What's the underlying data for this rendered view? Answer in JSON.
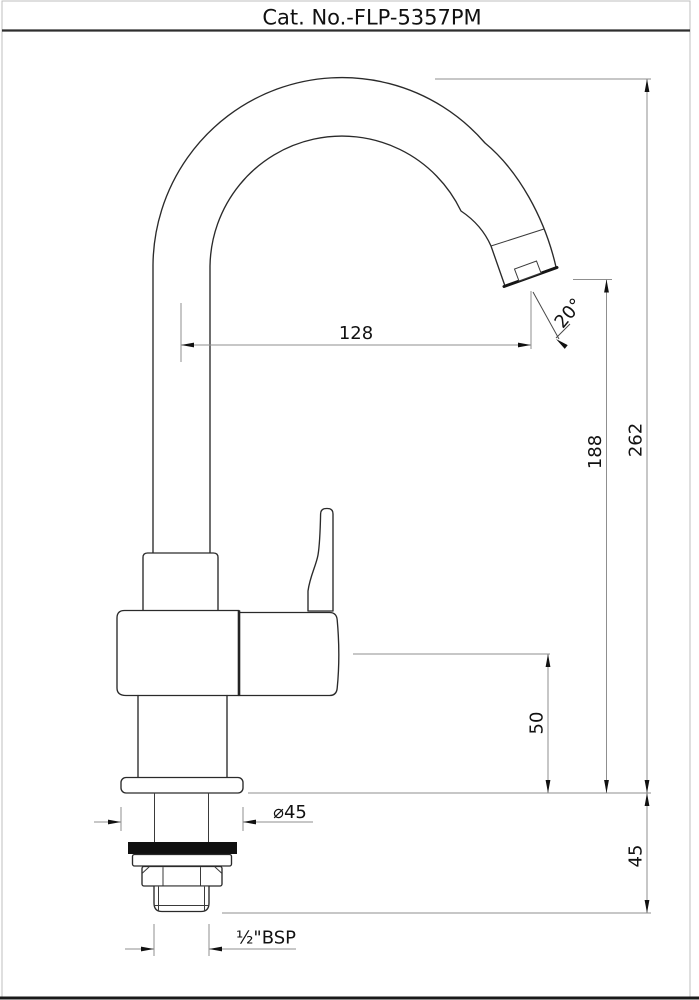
{
  "title_bar": {
    "catalog_number": "Cat. No.-FLP-5357PM"
  },
  "dimensions": {
    "spout_reach": "128",
    "spout_angle": "20°",
    "spout_outlet_height": "188",
    "overall_height": "262",
    "body_height": "50",
    "shank_length": "45",
    "flange_diameter": "⌀45",
    "inlet_thread": "½\"BSP"
  }
}
